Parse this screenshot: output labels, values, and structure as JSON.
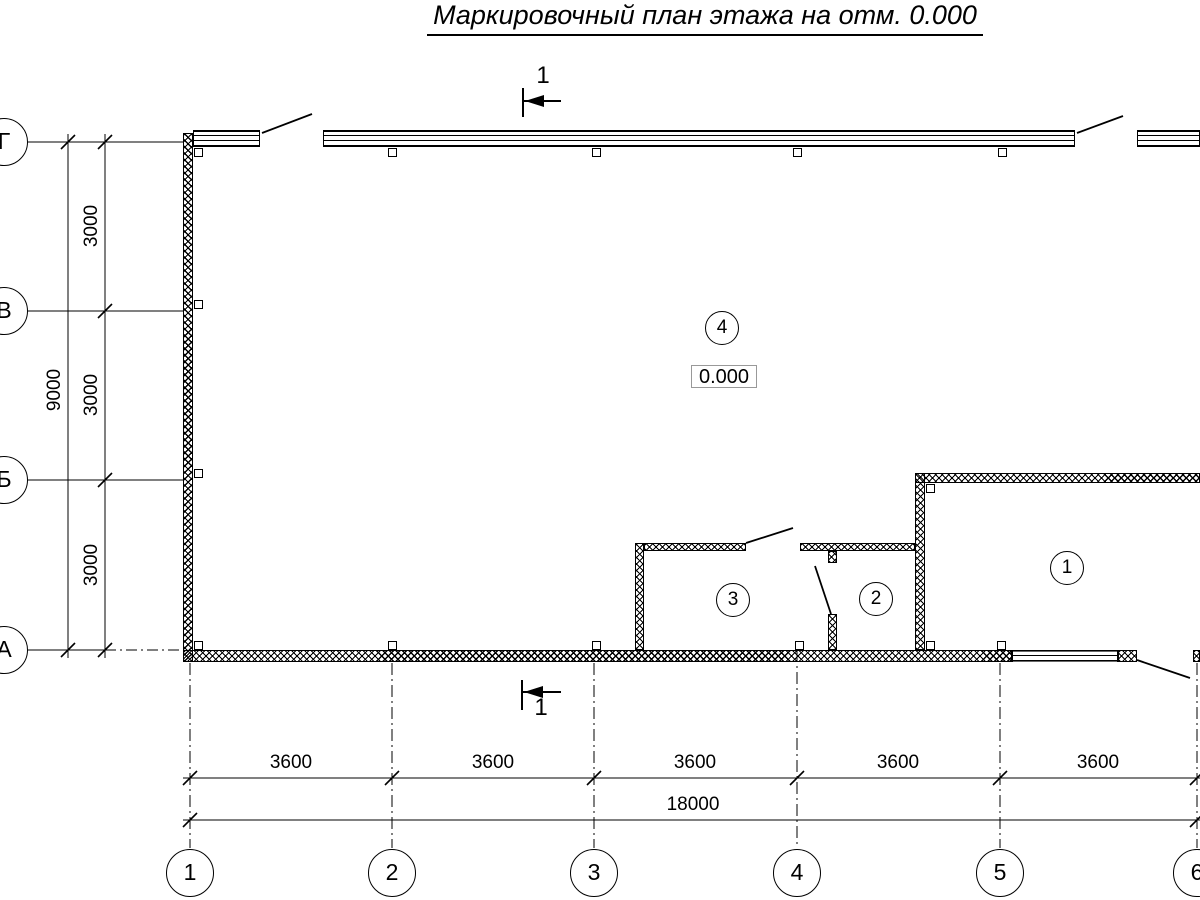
{
  "title": "Маркировочный план этажа на отм. 0.000",
  "section": {
    "top_label": "1",
    "bottom_label": "1"
  },
  "elevation": {
    "value": "0.000"
  },
  "rooms": [
    {
      "label": "1"
    },
    {
      "label": "2"
    },
    {
      "label": "3"
    },
    {
      "label": "4"
    }
  ],
  "grid": {
    "columns": [
      "1",
      "2",
      "3",
      "4",
      "5",
      "6"
    ],
    "rows": [
      "Г",
      "В",
      "Б",
      "А"
    ]
  },
  "dimensions": {
    "bottom_bays": [
      "3600",
      "3600",
      "3600",
      "3600",
      "3600"
    ],
    "bottom_total": "18000",
    "left_bays": [
      "3000",
      "3000",
      "3000"
    ],
    "left_total": "9000"
  }
}
